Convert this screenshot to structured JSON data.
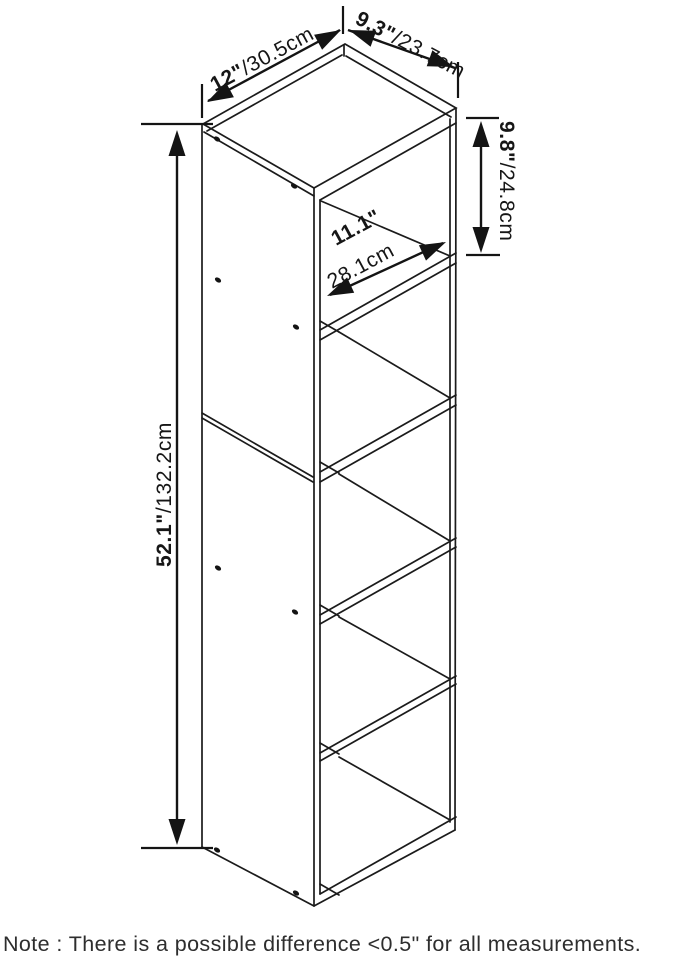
{
  "diagram": {
    "title": "5-cube storage shelf dimension drawing",
    "dims": {
      "width": {
        "inch": "12\"",
        "metric": "/30.5cm"
      },
      "depth": {
        "inch": "9.3\"",
        "metric": "/23.7cm"
      },
      "cubby": {
        "inch": "9.8\"",
        "metric": "/24.8cm"
      },
      "interior": {
        "inch": "11.1\"",
        "metric": "28.1cm"
      },
      "height": {
        "inch": "52.1\"",
        "metric": "/132.2cm"
      }
    },
    "note": "Note : There is a possible difference <0.5\" for all measurements.",
    "colors": {
      "line": "#1b1b1b",
      "background": "#ffffff"
    }
  }
}
